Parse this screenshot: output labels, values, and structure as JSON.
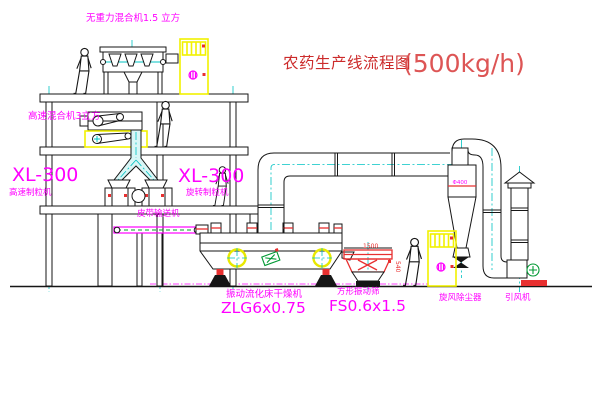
{
  "title": {
    "text": "农药生产线流程图",
    "capacity": "(500kg/h)"
  },
  "equipment_labels": {
    "top_mixer": "无重力混合机1.5 立方",
    "second_floor_mixer": "高速混合机3立方",
    "left_granulator_model": "XL-300",
    "left_granulator_name": "高速制粒机",
    "right_granulator_model": "XL-300",
    "right_granulator_name": "旋转制粒机",
    "belt_conveyor": "皮带输送机",
    "fluid_bed_dryer_name": "振动流化床干燥机",
    "fluid_bed_dryer_model": "ZLG6x0.75",
    "vibrating_screen_name": "方形振动筛",
    "vibrating_screen_model": "FS0.6x1.5",
    "cyclone_dust_collector": "旋风除尘器",
    "induced_draft_fan": "引风机",
    "cyclone_size": "Φ400"
  },
  "dimensions": {
    "screen_length": "1500",
    "screen_height": "540"
  },
  "colors": {
    "background": "#ffffff",
    "outline_black": "#161616",
    "label_magenta": "#ff00ff",
    "title_red": "#cc2b2b",
    "accent_red": "#e83030",
    "centerline_cyan": "#00c3c3",
    "cabinet_yellow": "#f2f200",
    "motor_green": "#009933"
  }
}
